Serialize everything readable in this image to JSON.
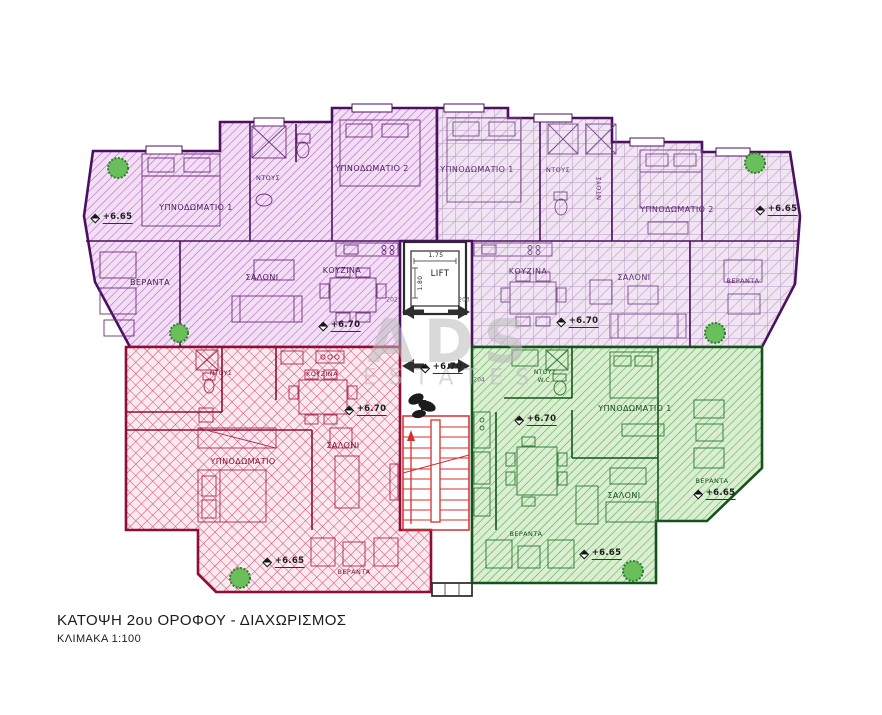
{
  "title": {
    "line1": "ΚΑΤΟΨΗ  2ου ΟΡΟΦΟΥ - ΔΙΑΧΩΡΙΣΜΟΣ",
    "line2": "ΚΛΙΜΑΚΑ   1:100"
  },
  "watermark": {
    "name": "ADS",
    "suffix": "ESTATES"
  },
  "core": {
    "lift_label": "LIFT",
    "lift_width": "1.75",
    "lift_depth": "1.80",
    "hall_level": "+6.70"
  },
  "door_numbers": {
    "left": "202",
    "right_top": "203",
    "right_bottom": "204"
  },
  "colors": {
    "purple_zone": "#aa63bb",
    "lilac_zone": "#b697c0",
    "red_zone": "#d24e74",
    "green_zone": "#55a156",
    "purple_wall": "#4b1160",
    "red_wall": "#8f0f32",
    "green_wall": "#14541c",
    "stair_red": "#d32f2f",
    "tree_green": "#6abf5a"
  },
  "apartments": {
    "top_left": {
      "labels": {
        "bedroom1": "ΥΠΝΟΔΩΜΑΤΙΟ 1",
        "shower": "ΝΤΟΥΣ",
        "bedroom2": "ΥΠΝΟΔΩΜΑΤΙΟ 2",
        "veranda": "ΒΕΡΑΝΤΑ",
        "living": "ΣΑΛΟΝΙ",
        "kitchen": "ΚΟΥΖΙΝΑ",
        "level_interior": "+6.70",
        "level_veranda": "+6.65"
      }
    },
    "top_right": {
      "labels": {
        "bedroom1": "ΥΠΝΟΔΩΜΑΤΙΟ 1",
        "shower1": "ΝΤΟΥΣ",
        "shower2": "ΝΤΟΥΣ",
        "bedroom2": "ΥΠΝΟΔΩΜΑΤΙΟ 2",
        "kitchen": "ΚΟΥΖΙΝΑ",
        "living": "ΣΑΛΟΝΙ",
        "veranda": "ΒΕΡΑΝΤΑ",
        "level_interior": "+6.70",
        "level_veranda": "+6.65"
      }
    },
    "bottom_left": {
      "labels": {
        "shower": "ΝΤΟΥΣ",
        "kitchen": "ΚΟΥΖΙΝΑ",
        "bedroom": "ΥΠΝΟΔΩΜΑΤΙΟ",
        "living": "ΣΑΛΟΝΙ",
        "veranda": "ΒΕΡΑΝΤΑ",
        "level_interior": "+6.70",
        "level_veranda": "+6.65"
      }
    },
    "bottom_right": {
      "labels": {
        "shower": "ΝΤΟΥΣ",
        "wc": "W.C.",
        "bedroom1": "ΥΠΝΟΔΩΜΑΤΙΟ 1",
        "living": "ΣΑΛΟΝΙ",
        "veranda_bottom": "ΒΕΡΑΝΤΑ",
        "veranda_right": "ΒΕΡΑΝΤΑ",
        "level_interior": "+6.70",
        "level_veranda_bottom": "+6.65",
        "level_veranda_right": "+6.65"
      }
    }
  }
}
